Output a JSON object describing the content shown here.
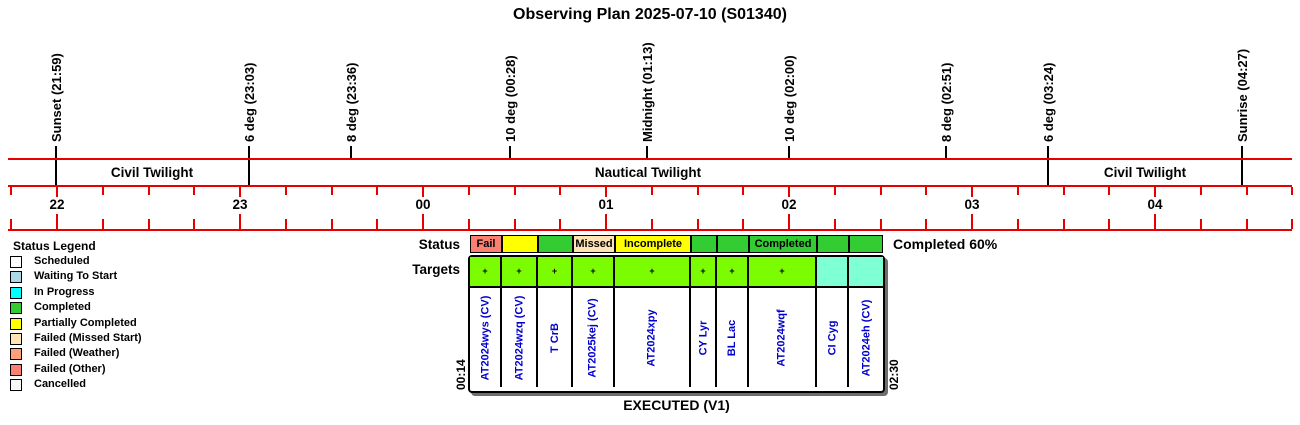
{
  "title": "Observing Plan 2025-07-10 (S01340)",
  "colors": {
    "axis_red": "#e80000",
    "name_text_blue": "#0000cd",
    "status_green": "#33cc33",
    "target_green": "#7cfc00",
    "target_aquamarine": "#7fffd4"
  },
  "timeline": {
    "markers": [
      {
        "label": "Sunset (21:59)",
        "x": 56,
        "boundary": true
      },
      {
        "label": "6 deg (23:03)",
        "x": 249,
        "boundary": true
      },
      {
        "label": "8 deg (23:36)",
        "x": 351,
        "boundary": false
      },
      {
        "label": "10 deg (00:28)",
        "x": 510,
        "boundary": false
      },
      {
        "label": "Midnight (01:13)",
        "x": 647,
        "boundary": false
      },
      {
        "label": "10 deg (02:00)",
        "x": 789,
        "boundary": false
      },
      {
        "label": "8 deg (02:51)",
        "x": 946,
        "boundary": false
      },
      {
        "label": "6 deg (03:24)",
        "x": 1048,
        "boundary": true
      },
      {
        "label": "Sunrise (04:27)",
        "x": 1242,
        "boundary": true
      }
    ],
    "bands": [
      {
        "label": "Civil Twilight",
        "center_x": 152
      },
      {
        "label": "Nautical Twilight",
        "center_x": 648
      },
      {
        "label": "Civil Twilight",
        "center_x": 1145
      }
    ],
    "hours": [
      {
        "label": "22",
        "x": 57
      },
      {
        "label": "23",
        "x": 240
      },
      {
        "label": "00",
        "x": 423
      },
      {
        "label": "01",
        "x": 606
      },
      {
        "label": "02",
        "x": 789
      },
      {
        "label": "03",
        "x": 972
      },
      {
        "label": "04",
        "x": 1155
      }
    ]
  },
  "legend": {
    "title": "Status Legend",
    "items": [
      {
        "label": "Scheduled",
        "color": "#ffffff"
      },
      {
        "label": "Waiting To Start",
        "color": "#add8e6"
      },
      {
        "label": "In Progress",
        "color": "#00ffff"
      },
      {
        "label": "Completed",
        "color": "#33cc33"
      },
      {
        "label": "Partially Completed",
        "color": "#ffff00"
      },
      {
        "label": "Failed (Missed Start)",
        "color": "#ffe4b5"
      },
      {
        "label": "Failed (Weather)",
        "color": "#ffa07a"
      },
      {
        "label": "Failed (Other)",
        "color": "#fa8072"
      },
      {
        "label": "Cancelled",
        "color": "#f8f8f8"
      }
    ]
  },
  "plan": {
    "status_label": "Status",
    "targets_label": "Targets",
    "summary": "Completed 60%",
    "start_time": "00:14",
    "end_time": "02:30",
    "footer": "EXECUTED (V1)",
    "cell_widths": [
      32,
      36,
      35,
      42,
      76,
      26,
      32,
      68,
      32,
      34
    ],
    "status_cells": [
      {
        "label": "Fail",
        "color": "#fa8072"
      },
      {
        "label": "",
        "color": "#ffff00"
      },
      {
        "label": "",
        "color": "#33cc33"
      },
      {
        "label": "Missed",
        "color": "#ffe4b5"
      },
      {
        "label": "Incomplete",
        "color": "#ffff00"
      },
      {
        "label": "",
        "color": "#33cc33"
      },
      {
        "label": "",
        "color": "#33cc33"
      },
      {
        "label": "Completed",
        "color": "#33cc33"
      },
      {
        "label": "",
        "color": "#33cc33"
      },
      {
        "label": "",
        "color": "#33cc33"
      }
    ],
    "target_cells": [
      {
        "name": "AT2024wys (CV)",
        "color": "#7cfc00",
        "marker": true
      },
      {
        "name": "AT2024wzq (CV)",
        "color": "#7cfc00",
        "marker": true
      },
      {
        "name": "T CrB",
        "color": "#7cfc00",
        "marker": true
      },
      {
        "name": "AT2025kej (CV)",
        "color": "#7cfc00",
        "marker": true
      },
      {
        "name": "AT2024xpy",
        "color": "#7cfc00",
        "marker": true
      },
      {
        "name": "CY Lyr",
        "color": "#7cfc00",
        "marker": true
      },
      {
        "name": "BL Lac",
        "color": "#7cfc00",
        "marker": true
      },
      {
        "name": "AT2024wqf",
        "color": "#7cfc00",
        "marker": true
      },
      {
        "name": "CI Cyg",
        "color": "#7fffd4",
        "marker": false
      },
      {
        "name": "AT2024eh (CV)",
        "color": "#7fffd4",
        "marker": false
      }
    ]
  },
  "chart_data": {
    "type": "timeline",
    "title": "Observing Plan 2025-07-10 (S01340)",
    "x_axis": {
      "unit": "hours",
      "tick_labels": [
        "22",
        "23",
        "00",
        "01",
        "02",
        "03",
        "04"
      ],
      "minor_tick_interval_minutes": 15
    },
    "events": [
      {
        "name": "Sunset",
        "time": "21:59"
      },
      {
        "name": "6 deg",
        "time": "23:03"
      },
      {
        "name": "8 deg",
        "time": "23:36"
      },
      {
        "name": "10 deg",
        "time": "00:28"
      },
      {
        "name": "Midnight",
        "time": "01:13"
      },
      {
        "name": "10 deg",
        "time": "02:00"
      },
      {
        "name": "8 deg",
        "time": "02:51"
      },
      {
        "name": "6 deg",
        "time": "03:24"
      },
      {
        "name": "Sunrise",
        "time": "04:27"
      }
    ],
    "twilight_bands": [
      {
        "label": "Civil Twilight",
        "from": "21:59",
        "to": "23:03"
      },
      {
        "label": "Nautical Twilight",
        "from": "23:03",
        "to": "03:24"
      },
      {
        "label": "Civil Twilight",
        "from": "03:24",
        "to": "04:27"
      }
    ],
    "executed_plan": {
      "label": "EXECUTED (V1)",
      "window_start": "00:14",
      "window_end": "02:30",
      "completion": "Completed 60%",
      "targets": [
        {
          "name": "AT2024wys (CV)",
          "status": "Fail"
        },
        {
          "name": "AT2024wzq (CV)",
          "status": "Partially Completed"
        },
        {
          "name": "T CrB",
          "status": "Completed"
        },
        {
          "name": "AT2025kej (CV)",
          "status": "Missed"
        },
        {
          "name": "AT2024xpy",
          "status": "Incomplete"
        },
        {
          "name": "CY Lyr",
          "status": "Completed"
        },
        {
          "name": "BL Lac",
          "status": "Completed"
        },
        {
          "name": "AT2024wqf",
          "status": "Completed"
        },
        {
          "name": "CI Cyg",
          "status": "Completed"
        },
        {
          "name": "AT2024eh (CV)",
          "status": "Completed"
        }
      ]
    }
  }
}
